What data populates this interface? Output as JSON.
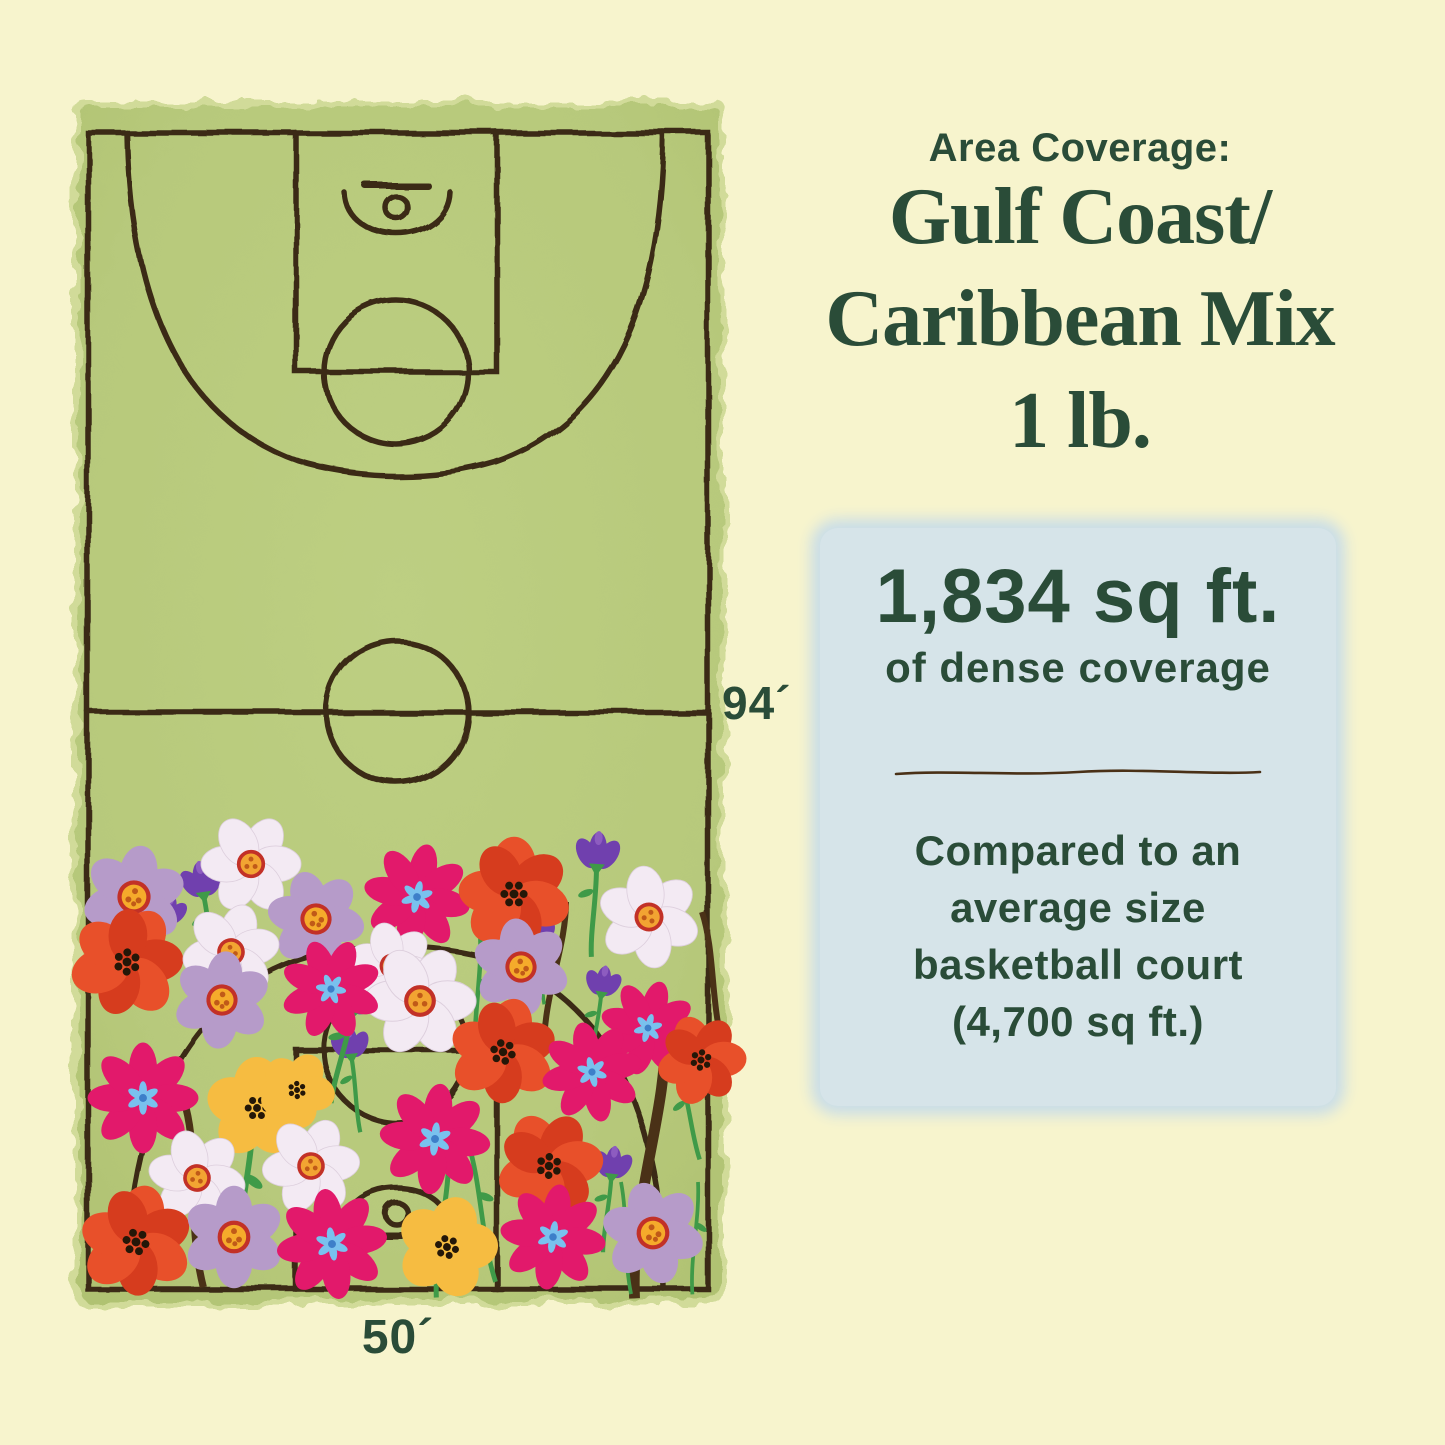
{
  "header": {
    "kicker": "Area Coverage:",
    "title_lines": [
      "Gulf Coast/",
      "Caribbean Mix",
      "1 lb."
    ]
  },
  "info_box": {
    "stat_value": "1,834 sq ft.",
    "stat_caption": "of dense coverage",
    "comparison_lines": [
      "Compared to an",
      "average size",
      "basketball court",
      "(4,700 sq ft.)"
    ]
  },
  "court": {
    "length_label": "94´",
    "width_label": "50´"
  },
  "colors": {
    "background": "#f7f4cd",
    "text": "#2a4c38",
    "bluebox": "#d6e4e9",
    "bluebox-glow": "#c9dde8",
    "court": "#b7c97b",
    "court-light": "#cdd994",
    "line": "#3a2b13",
    "divider": "#4a3117",
    "magenta": "#e2196b",
    "blue-center": "#79c1ee",
    "blue-center-dark": "#3d7fc9",
    "lavender": "#b69bc9",
    "white-daisy": "#f3eaf3",
    "center-yellow": "#f5ab2b",
    "center-orange": "#f2a432",
    "center-ring": "#c23127",
    "center-dots": "#c05a18",
    "poppy": "#e8502a",
    "poppy-dark": "#d63c1e",
    "sunny": "#f6bc41",
    "purple": "#7040ae",
    "purple-light": "#8d5cc0",
    "stem-green": "#3f9a48",
    "stem-brown": "#4a3117",
    "dots-black": "#241708"
  },
  "illustration": {
    "flowers": [
      {
        "t": "stemb",
        "x": 186,
        "y": 1108,
        "s": 1.2,
        "r": -4
      },
      {
        "t": "stemb",
        "x": 566,
        "y": 902,
        "s": 1.0,
        "r": 10
      },
      {
        "t": "stemb",
        "x": 665,
        "y": 1030,
        "s": 1.8,
        "r": 8
      },
      {
        "t": "stemb",
        "x": 702,
        "y": 912,
        "s": 1.0,
        "r": -8
      },
      {
        "t": "stemg",
        "x": 449,
        "y": 1148,
        "s": 1.0,
        "r": 6
      },
      {
        "t": "stemg",
        "x": 468,
        "y": 1142,
        "s": 0.95,
        "r": -10
      },
      {
        "t": "stemg",
        "x": 253,
        "y": 1112,
        "s": 1.15,
        "r": 7
      },
      {
        "t": "stemg",
        "x": 291,
        "y": 1102,
        "s": 0.9,
        "r": -6
      },
      {
        "t": "stemg",
        "x": 698,
        "y": 1182,
        "s": 0.75,
        "r": 4
      },
      {
        "t": "stemg",
        "x": 621,
        "y": 1182,
        "s": 0.75,
        "r": -4
      },
      {
        "t": "stemg",
        "x": 480,
        "y": 930,
        "s": 0.9,
        "r": 3
      },
      {
        "t": "crocus",
        "x": 203,
        "y": 890,
        "s": 0.95,
        "r": -8
      },
      {
        "t": "crocus",
        "x": 167,
        "y": 918,
        "s": 0.8,
        "r": 12
      },
      {
        "t": "crocus",
        "x": 597,
        "y": 862,
        "s": 1.0,
        "r": 4
      },
      {
        "t": "crocus",
        "x": 540,
        "y": 938,
        "s": 0.7,
        "r": -3
      },
      {
        "t": "crocus",
        "x": 351,
        "y": 1052,
        "s": 0.85,
        "r": -6
      },
      {
        "t": "crocus",
        "x": 602,
        "y": 990,
        "s": 0.8,
        "r": 9
      },
      {
        "t": "crocus",
        "x": 681,
        "y": 1076,
        "s": 0.9,
        "r": -12
      },
      {
        "t": "crocus",
        "x": 612,
        "y": 1172,
        "s": 0.85,
        "r": 7
      },
      {
        "t": "crocus",
        "x": 354,
        "y": 1006,
        "s": 1.05,
        "r": 14
      },
      {
        "t": "lavender",
        "x": 134,
        "y": 897,
        "s": 0.85,
        "r": 10
      },
      {
        "t": "daisy",
        "x": 251,
        "y": 864,
        "s": 0.82,
        "r": 0
      },
      {
        "t": "lavender",
        "x": 316,
        "y": 919,
        "s": 0.8,
        "r": -18
      },
      {
        "t": "cosmos",
        "x": 417,
        "y": 897,
        "s": 0.85,
        "r": 12
      },
      {
        "t": "poppy",
        "x": 514,
        "y": 894,
        "s": 0.88,
        "r": 0
      },
      {
        "t": "daisy",
        "x": 649,
        "y": 917,
        "s": 0.84,
        "r": 22
      },
      {
        "t": "poppy",
        "x": 127,
        "y": 962,
        "s": 0.88,
        "r": 32
      },
      {
        "t": "daisy",
        "x": 231,
        "y": 952,
        "s": 0.8,
        "r": -12
      },
      {
        "t": "lavender",
        "x": 222,
        "y": 1000,
        "s": 0.8,
        "r": 6
      },
      {
        "t": "daisy",
        "x": 392,
        "y": 966,
        "s": 0.72,
        "r": 16
      },
      {
        "t": "daisy",
        "x": 420,
        "y": 1001,
        "s": 0.92,
        "r": 0
      },
      {
        "t": "lavender",
        "x": 521,
        "y": 967,
        "s": 0.8,
        "r": -8
      },
      {
        "t": "cosmos",
        "x": 331,
        "y": 989,
        "s": 0.8,
        "r": -22
      },
      {
        "t": "cosmos",
        "x": 648,
        "y": 1028,
        "s": 0.76,
        "r": 16
      },
      {
        "t": "poppy",
        "x": 701,
        "y": 1060,
        "s": 0.7,
        "r": -22
      },
      {
        "t": "cosmos",
        "x": 143,
        "y": 1098,
        "s": 0.88,
        "r": 0
      },
      {
        "t": "sunny",
        "x": 257,
        "y": 1108,
        "s": 0.88,
        "r": 0
      },
      {
        "t": "sunny",
        "x": 297,
        "y": 1090,
        "s": 0.66,
        "r": 28
      },
      {
        "t": "poppy",
        "x": 503,
        "y": 1052,
        "s": 0.84,
        "r": 16
      },
      {
        "t": "cosmos",
        "x": 592,
        "y": 1072,
        "s": 0.8,
        "r": -12
      },
      {
        "t": "cosmos",
        "x": 435,
        "y": 1139,
        "s": 0.88,
        "r": 6
      },
      {
        "t": "daisy",
        "x": 197,
        "y": 1178,
        "s": 0.8,
        "r": 12
      },
      {
        "t": "daisy",
        "x": 311,
        "y": 1166,
        "s": 0.8,
        "r": -6
      },
      {
        "t": "poppy",
        "x": 549,
        "y": 1166,
        "s": 0.84,
        "r": -28
      },
      {
        "t": "poppy",
        "x": 136,
        "y": 1242,
        "s": 0.88,
        "r": 12
      },
      {
        "t": "lavender",
        "x": 234,
        "y": 1237,
        "s": 0.84,
        "r": 0
      },
      {
        "t": "cosmos",
        "x": 332,
        "y": 1244,
        "s": 0.88,
        "r": -8
      },
      {
        "t": "sunny",
        "x": 447,
        "y": 1247,
        "s": 0.88,
        "r": 16
      },
      {
        "t": "cosmos",
        "x": 553,
        "y": 1237,
        "s": 0.84,
        "r": 8
      },
      {
        "t": "lavender",
        "x": 653,
        "y": 1233,
        "s": 0.84,
        "r": -14
      }
    ]
  }
}
